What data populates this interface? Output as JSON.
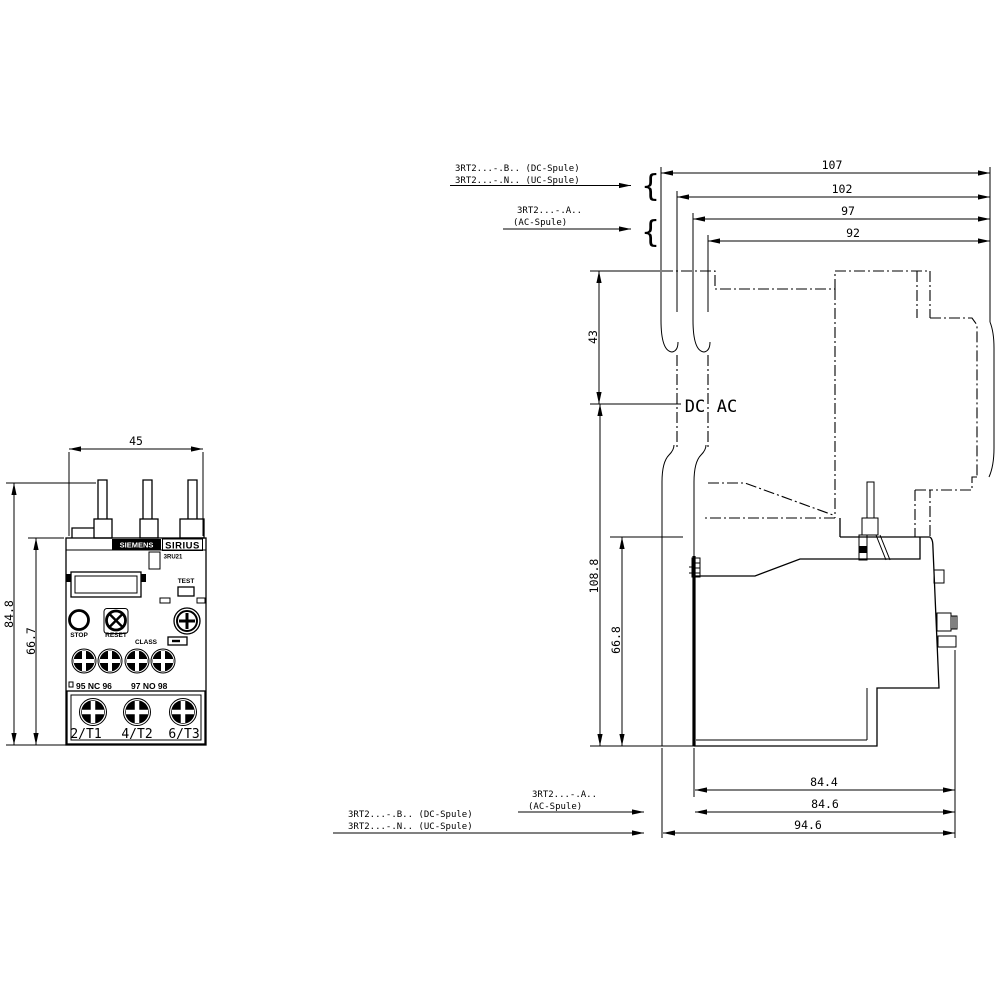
{
  "front_view": {
    "dim_width": "45",
    "dim_height_total": "84.8",
    "dim_height_body": "66.7",
    "brand": "SIEMENS",
    "series": "SIRIUS",
    "model": "3RU21",
    "test_label": "TEST",
    "stop_label": "STOP",
    "reset_label": "RESET",
    "class_label": "CLASS",
    "aux_terminals_left": "95 NC 96",
    "aux_terminals_right": "97 NO 98",
    "main_terminals": [
      "2/T1",
      "4/T2",
      "6/T3"
    ]
  },
  "side_view": {
    "dims_top": [
      "107",
      "102",
      "97",
      "92"
    ],
    "dim_contactor_top": "43",
    "dim_height_total": "108.8",
    "dim_height_body": "66.8",
    "dims_bottom": [
      "84.4",
      "84.6",
      "94.6"
    ],
    "coil_dc": "DC",
    "coil_ac": "AC",
    "labels_top_dc_line1": "3RT2...-.B.. (DC-Spule)",
    "labels_top_dc_line2": "3RT2...-.N.. (UC-Spule)",
    "labels_top_ac_line1": "3RT2...-.A..",
    "labels_top_ac_line2": "(AC-Spule)",
    "labels_bottom_ac_line1": "3RT2...-.A..",
    "labels_bottom_ac_line2": "(AC-Spule)",
    "labels_bottom_dc_line1": "3RT2...-.B.. (DC-Spule)",
    "labels_bottom_dc_line2": "3RT2...-.N.. (UC-Spule)",
    "brace": "{"
  },
  "colors": {
    "line": "#000000",
    "background": "#ffffff"
  }
}
